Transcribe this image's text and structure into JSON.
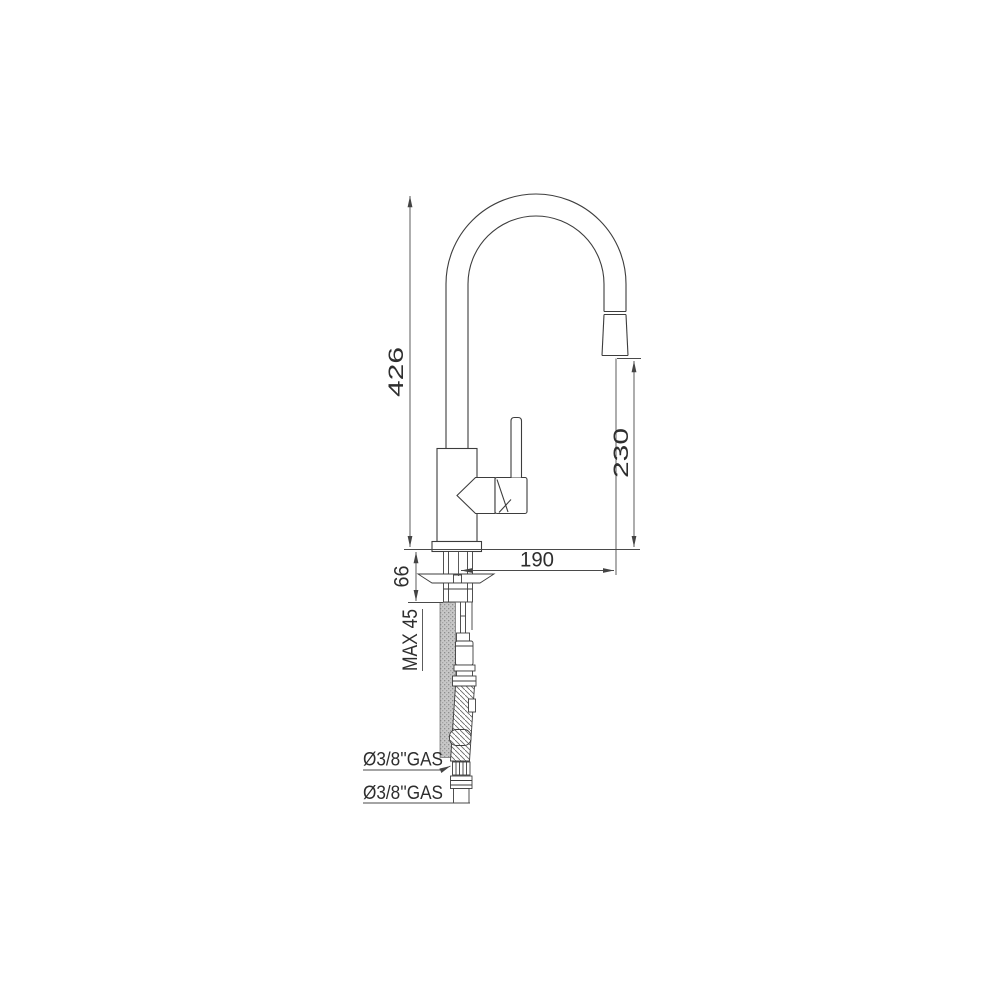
{
  "page": {
    "background": "#ffffff"
  },
  "drawing": {
    "type": "technical-drawing",
    "subject": "single-lever kitchen mixer tap with pull-out spray, side elevation with installation dimensions",
    "line_color": "#3d3d3d",
    "dim_color": "#4a4a4a",
    "text_color": "#2e2e2e",
    "hose_fill": "stippled-gray",
    "labels": {
      "total_height": "426",
      "outlet_height": "230",
      "spout_reach": "190",
      "shank_length": "66",
      "max_deck_thickness": "MAX 45",
      "spray_hose_connection": "Ø3/8''GAS",
      "supply_hose_connection": "Ø3/8''GAS"
    }
  }
}
